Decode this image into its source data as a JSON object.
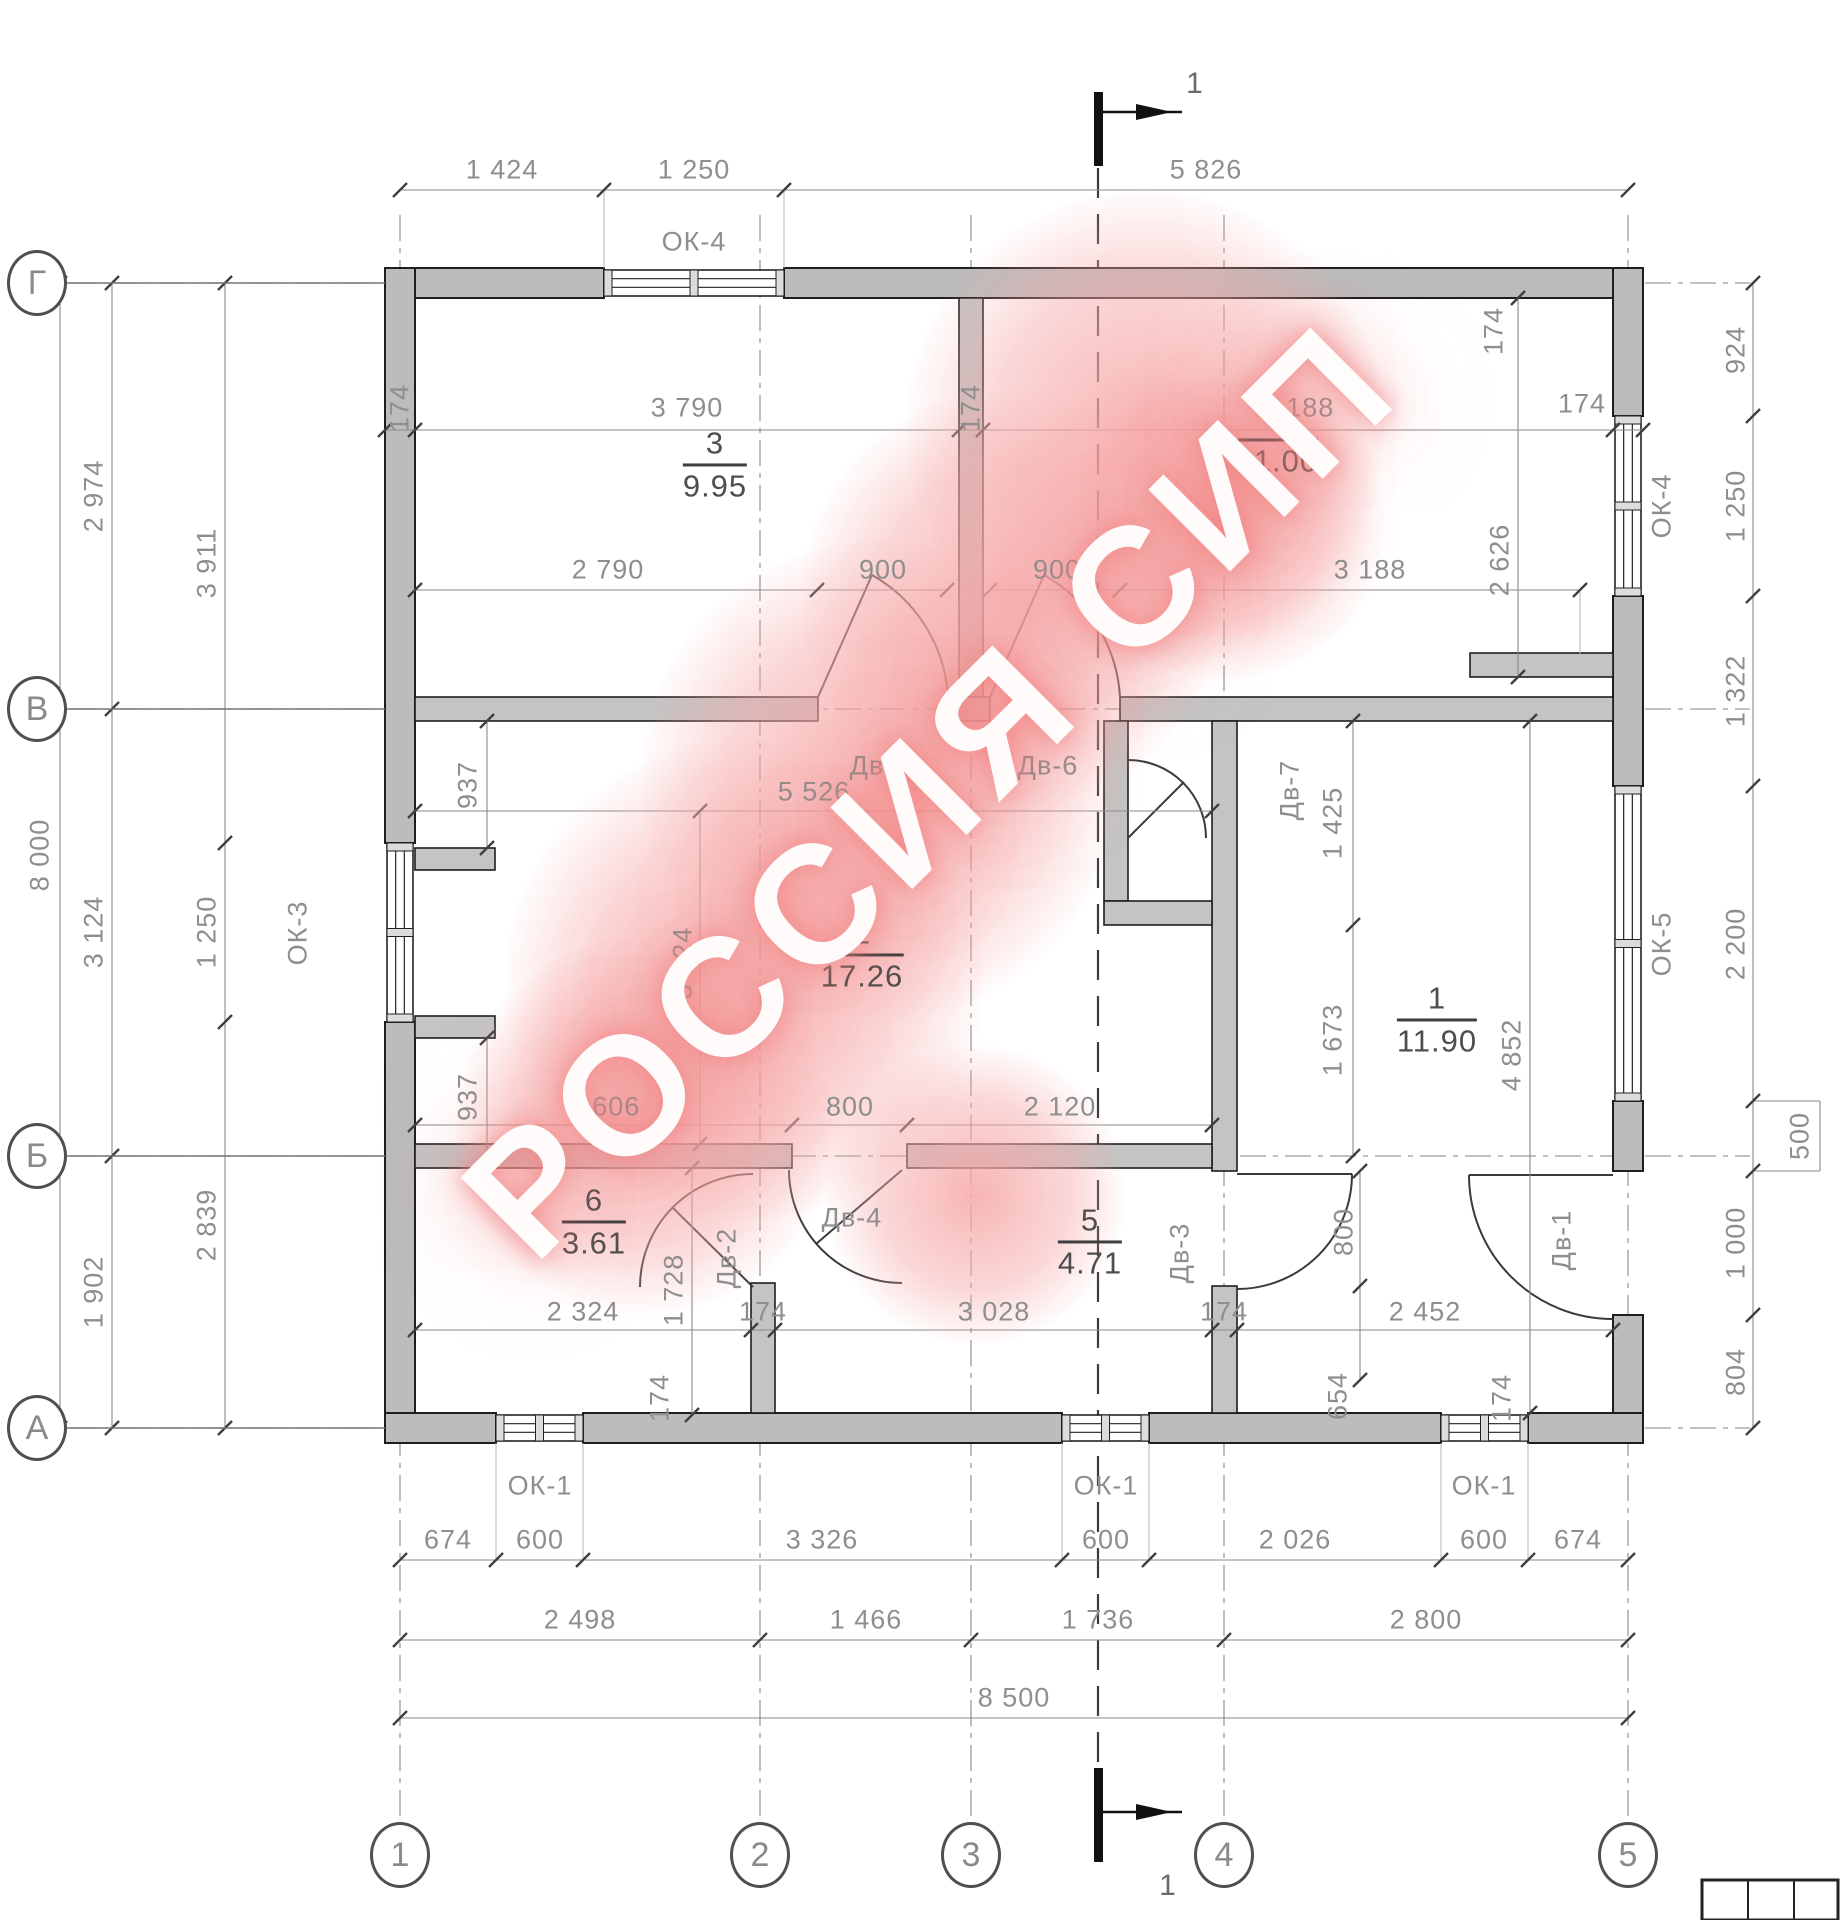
{
  "watermark": "РОССИЯ СИП",
  "section": {
    "label": "1"
  },
  "axes": {
    "left": [
      "Г",
      "В",
      "Б",
      "А"
    ],
    "bottom": [
      "1",
      "2",
      "3",
      "4",
      "5"
    ]
  },
  "rooms": [
    {
      "num": "1",
      "area": "11.90",
      "x": 1437,
      "y": 1020
    },
    {
      "num": "2",
      "area": "17.26",
      "x": 862,
      "y": 955
    },
    {
      "num": "3",
      "area": "9.95",
      "x": 715,
      "y": 465
    },
    {
      "num": "4",
      "area": "11.00",
      "x": 1278,
      "y": 440
    },
    {
      "num": "5",
      "area": "4.71",
      "x": 1090,
      "y": 1242
    },
    {
      "num": "6",
      "area": "3.61",
      "x": 594,
      "y": 1222
    }
  ],
  "labels": [
    {
      "t": "1 424",
      "x": 502,
      "y": 170,
      "r": 0,
      "k": "dim"
    },
    {
      "t": "1 250",
      "x": 694,
      "y": 170,
      "r": 0,
      "k": "dim"
    },
    {
      "t": "5 826",
      "x": 1206,
      "y": 170,
      "r": 0,
      "k": "dim"
    },
    {
      "t": "ОК-4",
      "x": 694,
      "y": 242,
      "r": 0,
      "k": "win"
    },
    {
      "t": "1",
      "x": 1195,
      "y": 84,
      "r": 0,
      "k": "sec"
    },
    {
      "t": "1",
      "x": 1168,
      "y": 1886,
      "r": 0,
      "k": "sec"
    },
    {
      "t": "8 000",
      "x": 40,
      "y": 855,
      "r": -90,
      "k": "dim"
    },
    {
      "t": "2 974",
      "x": 94,
      "y": 496,
      "r": -90,
      "k": "dim"
    },
    {
      "t": "3 124",
      "x": 94,
      "y": 932,
      "r": -90,
      "k": "dim"
    },
    {
      "t": "1 902",
      "x": 94,
      "y": 1292,
      "r": -90,
      "k": "dim"
    },
    {
      "t": "3 911",
      "x": 207,
      "y": 563,
      "r": -90,
      "k": "dim"
    },
    {
      "t": "1 250",
      "x": 207,
      "y": 932,
      "r": -90,
      "k": "dim"
    },
    {
      "t": "2 839",
      "x": 207,
      "y": 1225,
      "r": -90,
      "k": "dim"
    },
    {
      "t": "ОК-3",
      "x": 298,
      "y": 933,
      "r": -90,
      "k": "win"
    },
    {
      "t": "924",
      "x": 1736,
      "y": 350,
      "r": -90,
      "k": "dim"
    },
    {
      "t": "1 250",
      "x": 1736,
      "y": 506,
      "r": -90,
      "k": "dim"
    },
    {
      "t": "ОК-4",
      "x": 1662,
      "y": 506,
      "r": -90,
      "k": "win"
    },
    {
      "t": "1 322",
      "x": 1736,
      "y": 691,
      "r": -90,
      "k": "dim"
    },
    {
      "t": "2 200",
      "x": 1736,
      "y": 944,
      "r": -90,
      "k": "dim"
    },
    {
      "t": "ОК-5",
      "x": 1662,
      "y": 944,
      "r": -90,
      "k": "win"
    },
    {
      "t": "500",
      "x": 1800,
      "y": 1136,
      "r": -90,
      "k": "dim"
    },
    {
      "t": "1 000",
      "x": 1736,
      "y": 1243,
      "r": -90,
      "k": "dim"
    },
    {
      "t": "804",
      "x": 1736,
      "y": 1372,
      "r": -90,
      "k": "dim"
    },
    {
      "t": "674",
      "x": 448,
      "y": 1540,
      "r": 0,
      "k": "dim"
    },
    {
      "t": "600",
      "x": 540,
      "y": 1540,
      "r": 0,
      "k": "dim"
    },
    {
      "t": "3 326",
      "x": 822,
      "y": 1540,
      "r": 0,
      "k": "dim"
    },
    {
      "t": "600",
      "x": 1106,
      "y": 1540,
      "r": 0,
      "k": "dim"
    },
    {
      "t": "2 026",
      "x": 1295,
      "y": 1540,
      "r": 0,
      "k": "dim"
    },
    {
      "t": "600",
      "x": 1484,
      "y": 1540,
      "r": 0,
      "k": "dim"
    },
    {
      "t": "674",
      "x": 1578,
      "y": 1540,
      "r": 0,
      "k": "dim"
    },
    {
      "t": "ОК-1",
      "x": 540,
      "y": 1486,
      "r": 0,
      "k": "win"
    },
    {
      "t": "ОК-1",
      "x": 1106,
      "y": 1486,
      "r": 0,
      "k": "win"
    },
    {
      "t": "ОК-1",
      "x": 1484,
      "y": 1486,
      "r": 0,
      "k": "win"
    },
    {
      "t": "2 498",
      "x": 580,
      "y": 1620,
      "r": 0,
      "k": "dim"
    },
    {
      "t": "1 466",
      "x": 866,
      "y": 1620,
      "r": 0,
      "k": "dim"
    },
    {
      "t": "1 736",
      "x": 1098,
      "y": 1620,
      "r": 0,
      "k": "dim"
    },
    {
      "t": "2 800",
      "x": 1426,
      "y": 1620,
      "r": 0,
      "k": "dim"
    },
    {
      "t": "8 500",
      "x": 1014,
      "y": 1698,
      "r": 0,
      "k": "dim"
    },
    {
      "t": "174",
      "x": 400,
      "y": 408,
      "r": -90,
      "k": "dim"
    },
    {
      "t": "3 790",
      "x": 687,
      "y": 408,
      "r": 0,
      "k": "dim"
    },
    {
      "t": "174",
      "x": 971,
      "y": 408,
      "r": -90,
      "k": "dim"
    },
    {
      "t": "4 188",
      "x": 1298,
      "y": 408,
      "r": 0,
      "k": "dim"
    },
    {
      "t": "174",
      "x": 1494,
      "y": 331,
      "r": -90,
      "k": "dim"
    },
    {
      "t": "174",
      "x": 1582,
      "y": 404,
      "r": 0,
      "k": "dim"
    },
    {
      "t": "2 790",
      "x": 608,
      "y": 570,
      "r": 0,
      "k": "dim"
    },
    {
      "t": "900",
      "x": 883,
      "y": 570,
      "r": 0,
      "k": "dim"
    },
    {
      "t": "900",
      "x": 1057,
      "y": 570,
      "r": 0,
      "k": "dim"
    },
    {
      "t": "3 188",
      "x": 1370,
      "y": 570,
      "r": 0,
      "k": "dim"
    },
    {
      "t": "2 626",
      "x": 1500,
      "y": 560,
      "r": -90,
      "k": "dim"
    },
    {
      "t": "Дв-5",
      "x": 880,
      "y": 766,
      "r": 0,
      "k": "door"
    },
    {
      "t": "Дв-6",
      "x": 1048,
      "y": 766,
      "r": 0,
      "k": "door"
    },
    {
      "t": "5 526",
      "x": 814,
      "y": 792,
      "r": 0,
      "k": "dim"
    },
    {
      "t": "937",
      "x": 468,
      "y": 785,
      "r": -90,
      "k": "dim"
    },
    {
      "t": "937",
      "x": 468,
      "y": 1097,
      "r": -90,
      "k": "dim"
    },
    {
      "t": "3 124",
      "x": 683,
      "y": 963,
      "r": -90,
      "k": "dim"
    },
    {
      "t": "Дв-7",
      "x": 1290,
      "y": 790,
      "r": -90,
      "k": "door"
    },
    {
      "t": "1 425",
      "x": 1333,
      "y": 823,
      "r": -90,
      "k": "dim"
    },
    {
      "t": "1 673",
      "x": 1333,
      "y": 1040,
      "r": -90,
      "k": "dim"
    },
    {
      "t": "4 852",
      "x": 1512,
      "y": 1055,
      "r": -90,
      "k": "dim"
    },
    {
      "t": "2 606",
      "x": 604,
      "y": 1107,
      "r": 0,
      "k": "dim"
    },
    {
      "t": "800",
      "x": 850,
      "y": 1107,
      "r": 0,
      "k": "dim"
    },
    {
      "t": "2 120",
      "x": 1060,
      "y": 1107,
      "r": 0,
      "k": "dim"
    },
    {
      "t": "2 324",
      "x": 583,
      "y": 1312,
      "r": 0,
      "k": "dim"
    },
    {
      "t": "1 728",
      "x": 674,
      "y": 1290,
      "r": -90,
      "k": "dim"
    },
    {
      "t": "Дв-2",
      "x": 727,
      "y": 1258,
      "r": -90,
      "k": "door"
    },
    {
      "t": "174",
      "x": 763,
      "y": 1312,
      "r": 0,
      "k": "dim"
    },
    {
      "t": "3 028",
      "x": 994,
      "y": 1312,
      "r": 0,
      "k": "dim"
    },
    {
      "t": "Дв-4",
      "x": 852,
      "y": 1218,
      "r": 0,
      "k": "door"
    },
    {
      "t": "174",
      "x": 660,
      "y": 1398,
      "r": -90,
      "k": "dim"
    },
    {
      "t": "174",
      "x": 1224,
      "y": 1312,
      "r": 0,
      "k": "dim"
    },
    {
      "t": "Дв-3",
      "x": 1180,
      "y": 1253,
      "r": -90,
      "k": "door"
    },
    {
      "t": "800",
      "x": 1344,
      "y": 1232,
      "r": -90,
      "k": "dim"
    },
    {
      "t": "2 452",
      "x": 1425,
      "y": 1312,
      "r": 0,
      "k": "dim"
    },
    {
      "t": "654",
      "x": 1338,
      "y": 1396,
      "r": -90,
      "k": "dim"
    },
    {
      "t": "174",
      "x": 1502,
      "y": 1398,
      "r": -90,
      "k": "dim"
    },
    {
      "t": "Дв-1",
      "x": 1562,
      "y": 1240,
      "r": -90,
      "k": "door"
    }
  ]
}
